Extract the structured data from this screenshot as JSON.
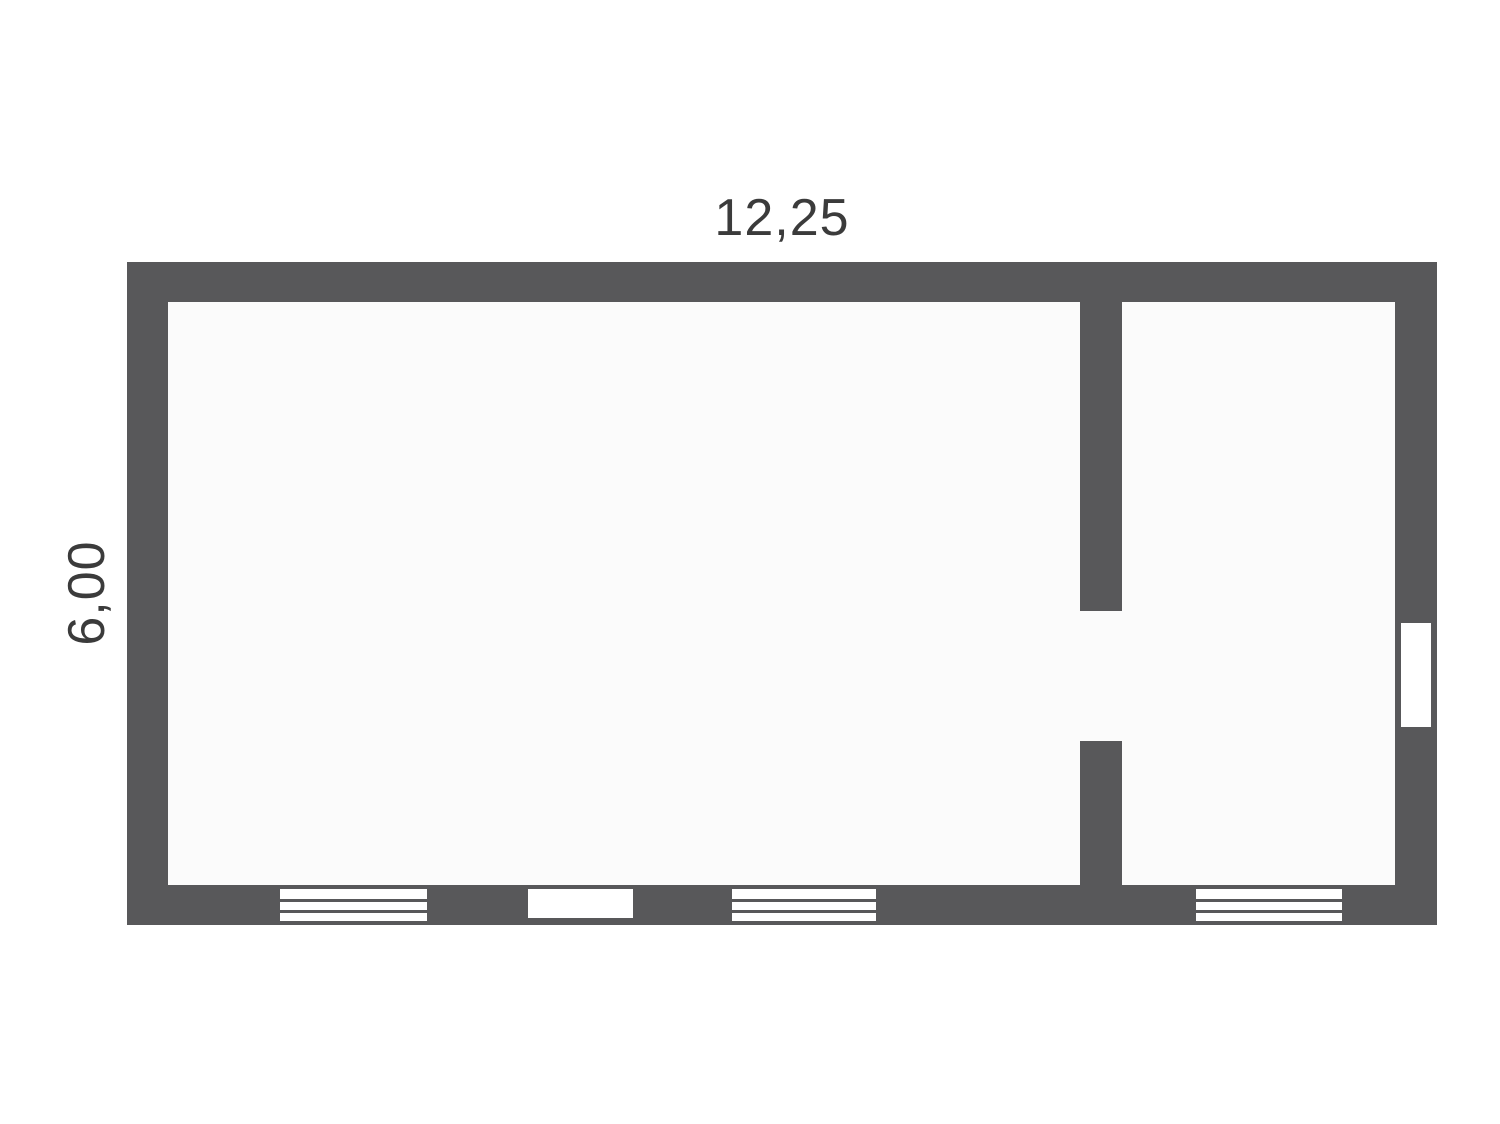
{
  "colors": {
    "background": "#ffffff",
    "wall": "#58585a",
    "floor": "#fbfbfb",
    "opening": "#ffffff",
    "label": "#3b3b3b"
  },
  "floor_plan": {
    "width_label": "12,25",
    "height_label": "6,00",
    "rooms": [
      {
        "name": "main-room"
      },
      {
        "name": "secondary-room"
      }
    ],
    "openings": [
      {
        "name": "window-1",
        "type": "window",
        "wall": "bottom"
      },
      {
        "name": "bottom-door",
        "type": "door",
        "wall": "bottom"
      },
      {
        "name": "window-2",
        "type": "window",
        "wall": "bottom"
      },
      {
        "name": "window-3",
        "type": "window",
        "wall": "bottom"
      },
      {
        "name": "right-window",
        "type": "window",
        "wall": "right"
      },
      {
        "name": "partition-doorway",
        "type": "doorway",
        "wall": "partition"
      }
    ]
  }
}
